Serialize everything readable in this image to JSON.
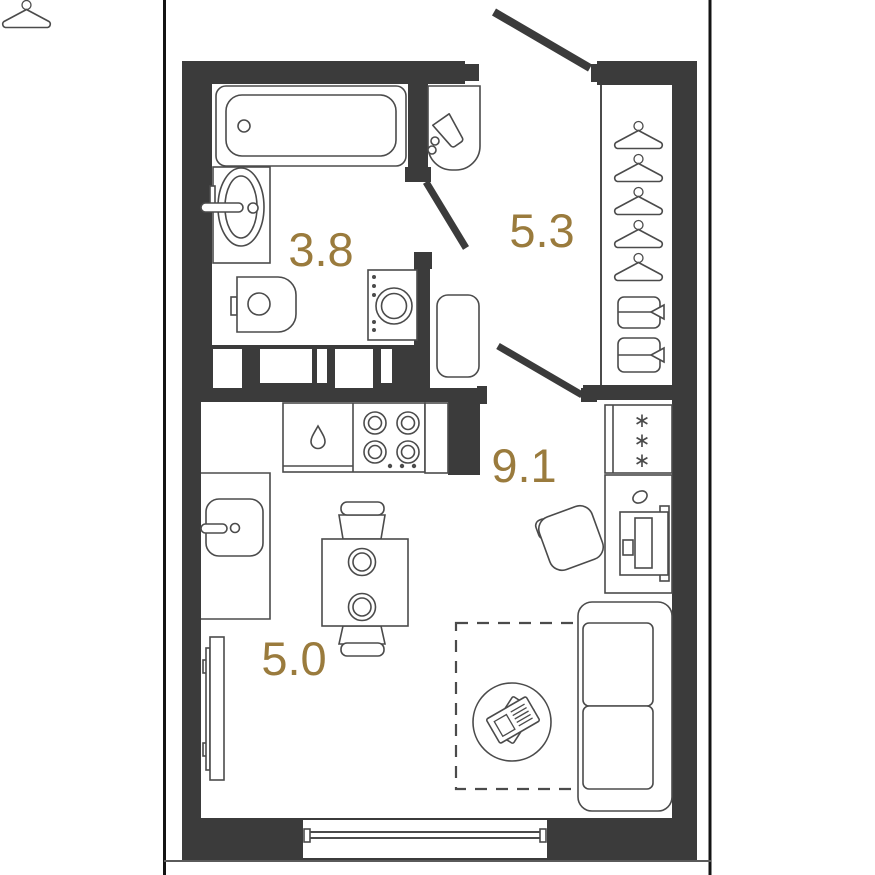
{
  "plan": {
    "title": "studio apartment floor plan",
    "rooms": [
      {
        "name": "bathroom",
        "area": "3.8"
      },
      {
        "name": "hallway",
        "area": "5.3"
      },
      {
        "name": "kitchen-living",
        "area": "9.1"
      },
      {
        "name": "living-zone",
        "area": "5.0"
      }
    ],
    "glyphs": {
      "freezer_asterisk": "∗"
    },
    "colors": {
      "wall": "#3b3b3b",
      "furniture_outline": "#4b4b4b",
      "area_label": "#9a7b3d",
      "frame_line": "#141414",
      "background": "#ffffff"
    },
    "furniture_icons": [
      "bathtub-icon",
      "washbasin-icon",
      "toilet-icon",
      "washing-machine-icon",
      "vanity-sink-icon",
      "hanger-icon",
      "drawer-icon",
      "shoe-cabinet-icon",
      "kitchen-sink-icon",
      "droplet-icon",
      "stove-icon",
      "fridge-icon",
      "desk-icon",
      "monitor-icon",
      "office-chair-icon",
      "dining-table-icon",
      "chair-icon",
      "tv-icon",
      "rug-icon",
      "coffee-table-icon",
      "newspaper-icon",
      "sofa-icon",
      "window-icon",
      "door-leaf-icon"
    ]
  }
}
